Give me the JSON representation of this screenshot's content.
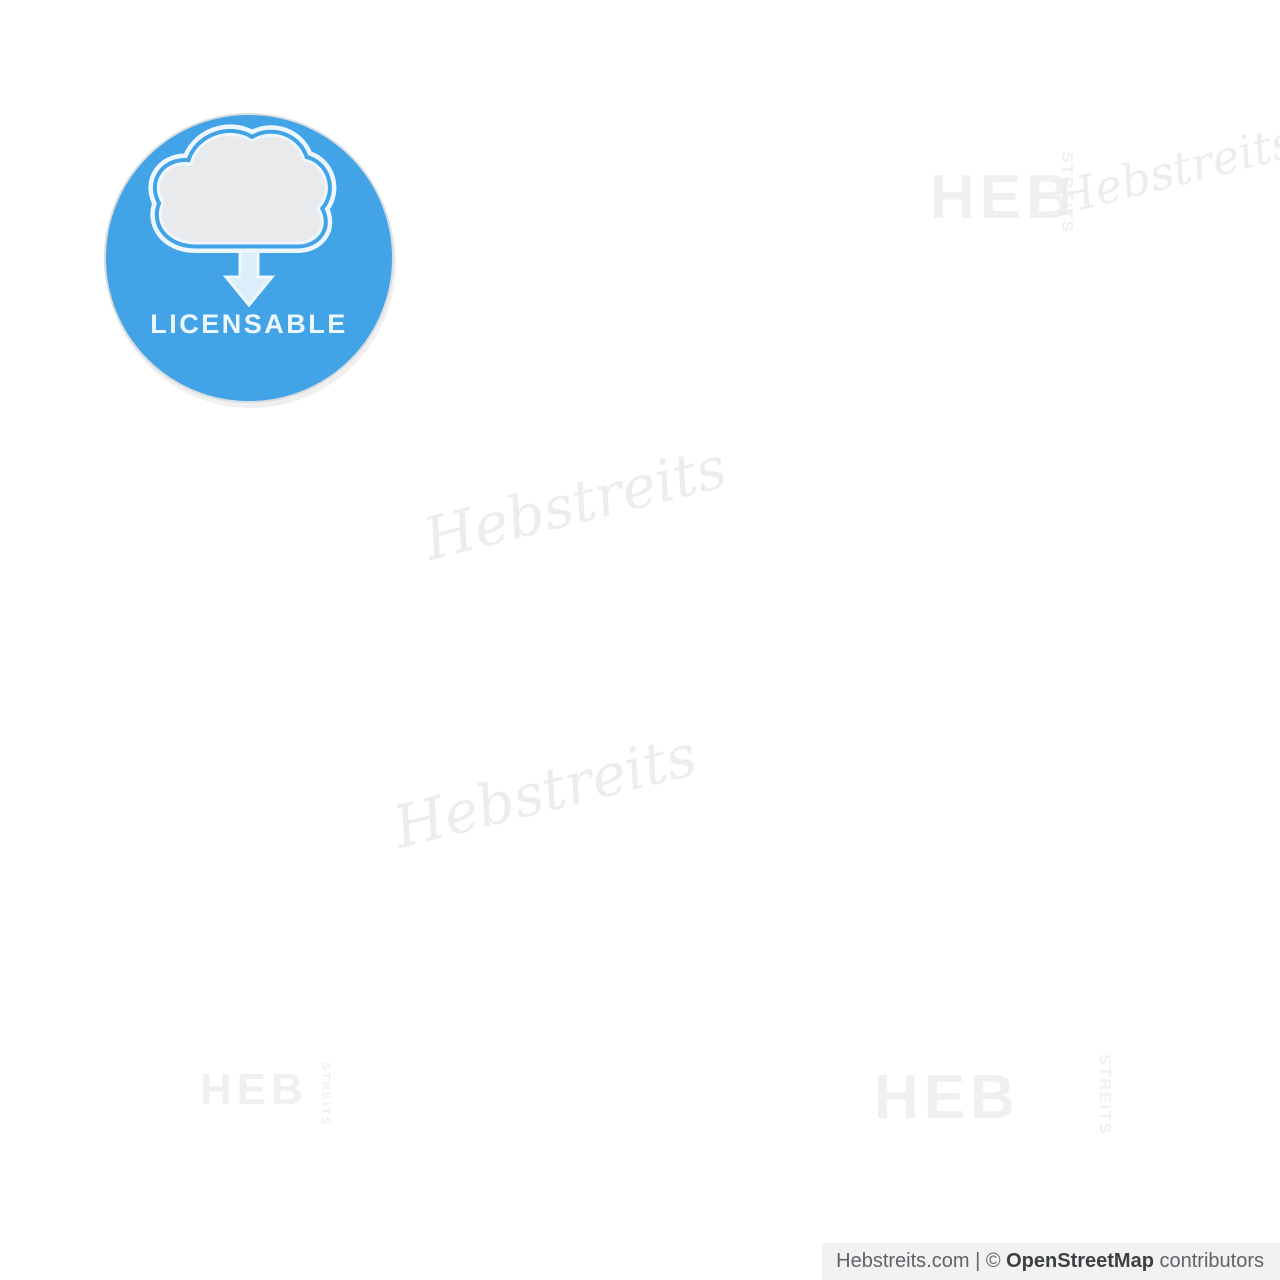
{
  "map": {
    "background_color": "#ffffff",
    "road_colors": {
      "highway": "#0f0f0f",
      "arterial": "#1c1c1c",
      "street": "#3f3f3f",
      "suburb": "#6f6f6f",
      "minor": "#b3b3b3",
      "rural": "#9c9c9c",
      "dash": "#8a8a8a",
      "park": "#ececec",
      "water": "#cccccc",
      "hatch": "#2f2f2f",
      "rail": "#111111"
    }
  },
  "badge": {
    "label": "LICENSABLE",
    "circle_color": "#42a4e6",
    "rim_color": "#d9dde0",
    "street_tint": "#1b86cc",
    "cloud_fill": "#e9eaeb",
    "cloud_outline": "#eef7ff",
    "arrow_color": "#dceefa",
    "text_color": "#edf7fe"
  },
  "watermarks": {
    "brand": "HEB",
    "brand_vertical": "STREITS",
    "script": "Hebstreits",
    "color": "#f0f0f0",
    "script_color": "#ededed"
  },
  "attribution": {
    "site": "Hebstreits.com",
    "separator": " | ",
    "copyright": "© ",
    "osm": "OpenStreetMap",
    "suffix": " contributors",
    "background": "#f1f1f1",
    "text_color": "#5f6368"
  }
}
